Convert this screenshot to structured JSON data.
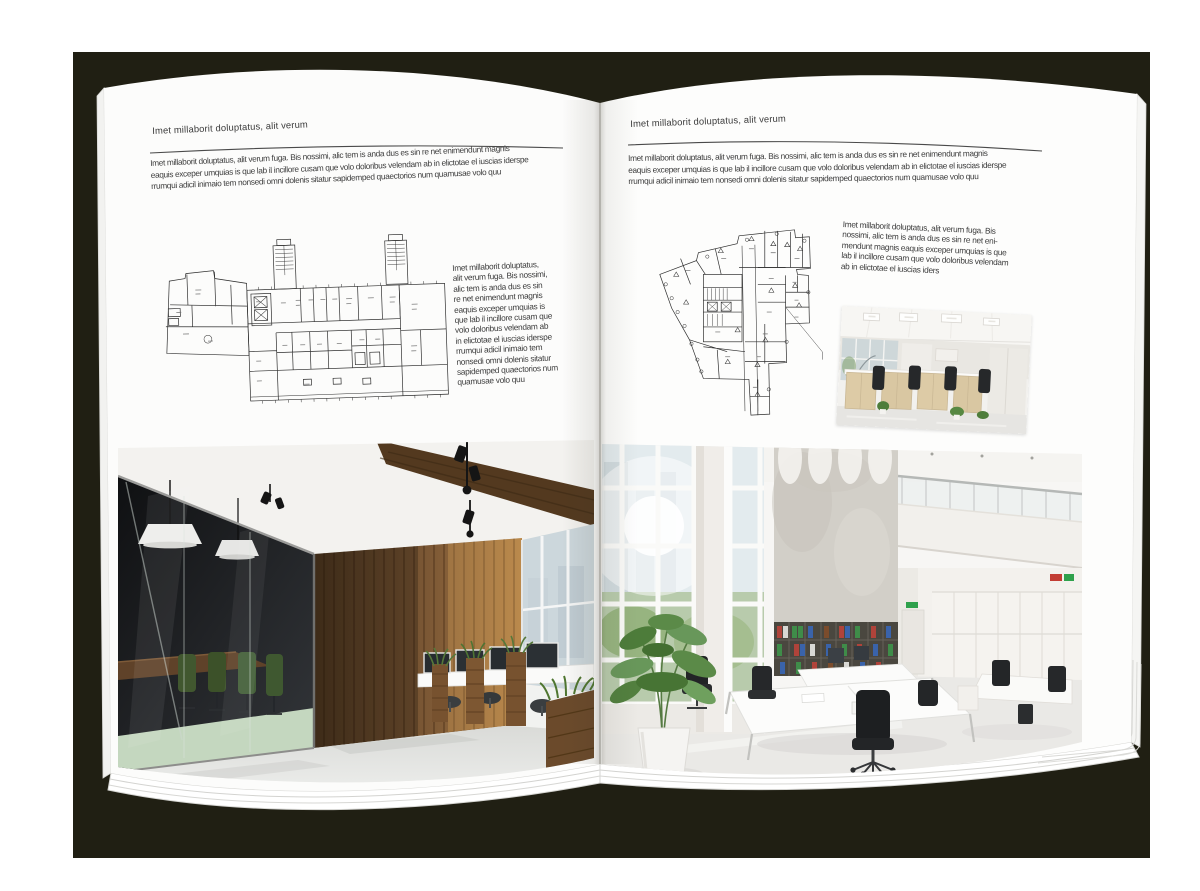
{
  "canvas": {
    "background_color": "#ffffff",
    "backdrop_color": "#201f13",
    "page_color": "#fdfdfd"
  },
  "left_page": {
    "header": "Imet millaborit doluptatus, alit verum",
    "body_lines": [
      "Imet millaborit doluptatus, alit verum fuga. Bis nossimi, alic tem is anda dus es sin re net enimendunt magnis",
      "eaquis exceper umquias is que lab il incillore cusam que volo doloribus velendam ab in elictotae el iuscias iderspe",
      "rrumqui adicil inimaio tem nonsedi omni dolenis sitatur sapidemped quaectorios num quamusae volo quu"
    ],
    "side_text_lines": [
      "Imet millaborit doluptatus,",
      "alit verum fuga. Bis nossimi,",
      "alic tem is anda dus es sin",
      "re net enimendunt magnis",
      "eaquis exceper umquias is",
      "que lab il incillore cusam que",
      "volo doloribus velendam ab",
      "in elictotae el iuscias iderspe",
      "rrumqui adicil inimaio tem",
      "nonsedi omni dolenis sitatur",
      "sapidemped quaectorios num",
      "quamusae volo quu"
    ]
  },
  "right_page": {
    "header": "Imet millaborit doluptatus, alit verum",
    "body_lines": [
      "Imet millaborit doluptatus, alit verum fuga. Bis nossimi, alic tem is anda dus es sin re net enimendunt magnis",
      "eaquis exceper umquias is que lab il incillore cusam que volo doloribus velendam ab in elictotae el iuscias iderspe",
      "rrumqui adicil inimaio tem nonsedi omni dolenis sitatur sapidemped quaectorios num quamusae volo quu"
    ],
    "side_text_lines": [
      "Imet millaborit doluptatus, alit verum fuga. Bis",
      "nossimi, alic tem is anda dus es sin re net eni-",
      "mendunt magnis eaquis exceper umquias is que",
      "lab il incillore cusam que volo doloribus velendam",
      "ab in elictotae el iuscias iders"
    ]
  }
}
